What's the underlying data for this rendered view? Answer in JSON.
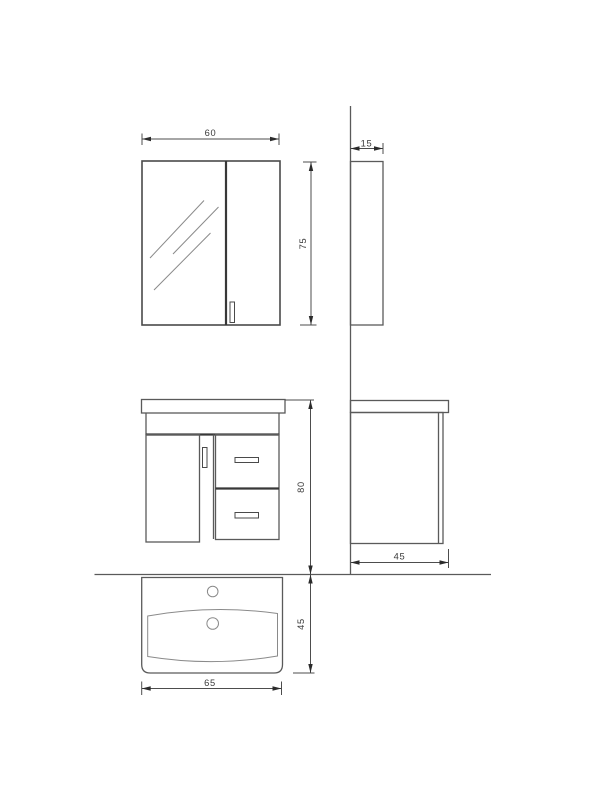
{
  "drawing": {
    "colors": {
      "background": "#ffffff",
      "line": "#5a5a5a",
      "dark_line": "#383838",
      "dimension_text": "#3a3a3a"
    },
    "views": {
      "mirror_cabinet_front": {
        "width_label": "60",
        "height_label": "75"
      },
      "mirror_cabinet_side": {
        "depth_label": "15"
      },
      "vanity_front": {
        "height_label": "80"
      },
      "vanity_side": {
        "depth_label": "45"
      },
      "basin_top": {
        "width_label": "65",
        "depth_label": "45"
      }
    }
  }
}
